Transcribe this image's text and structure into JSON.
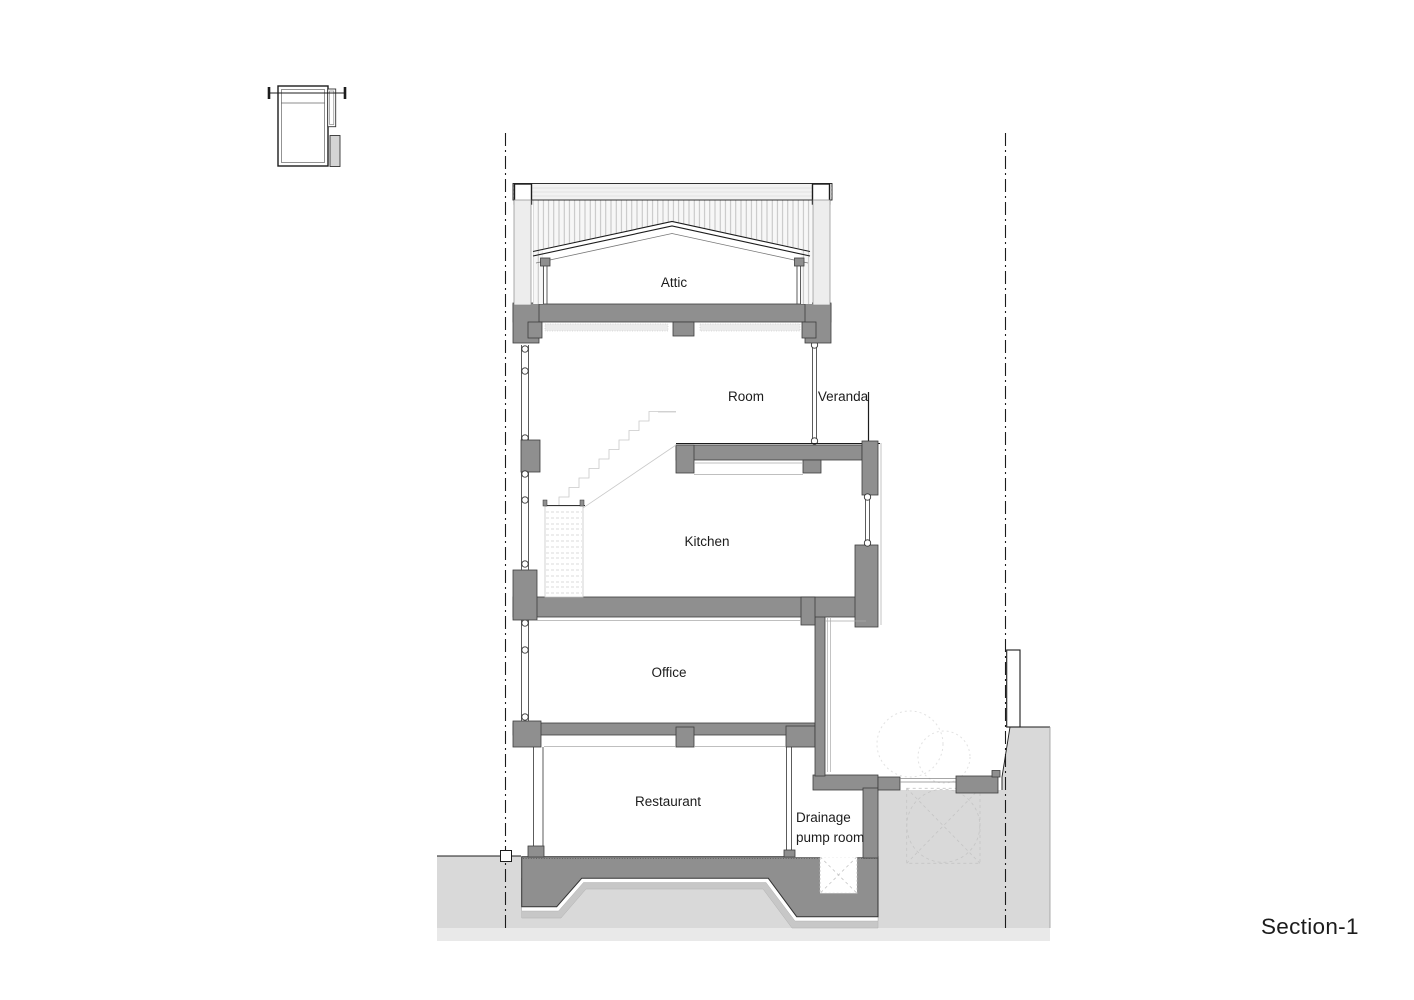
{
  "title": "Section-1",
  "drawing": {
    "labels": {
      "attic": "Attic",
      "room": "Room",
      "veranda": "Veranda",
      "kitchen": "Kitchen",
      "office": "Office",
      "restaurant": "Restaurant",
      "drainage_line1": "Drainage",
      "drainage_line2": "pump room"
    }
  },
  "colors": {
    "ink": "#1c1c1c",
    "cut-gray": "#8f8f8f",
    "cut-outline": "#3c3c3c",
    "ground-gray": "#d9d9d9",
    "ground-light": "#e9e9e9",
    "subbase-gray": "#c7c7c7",
    "paper": "#ffffff"
  }
}
